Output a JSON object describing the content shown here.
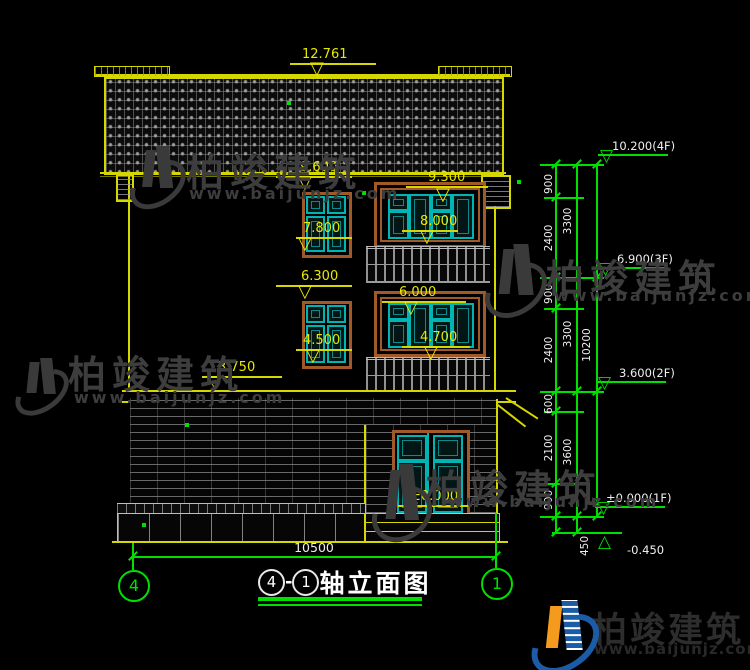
{
  "watermark": {
    "brand": "柏竣建筑",
    "site": "www.baijunjz.com"
  },
  "logo": {
    "brand": "柏竣建筑",
    "site": "www.baijunjz.com"
  },
  "facade": {
    "ridge_elevation": "12.761",
    "f3_left_window_head": "9.600",
    "f3_left_window_sill": "7.800",
    "f3_mid_window_head": "9.300",
    "f3_balcony_rail": "8.000",
    "f2_left_window_head": "6.300",
    "f2_left_window_sill": "4.500",
    "f2_mid_window_head": "6.000",
    "f2_balcony_rail": "4.700",
    "f2_slab": "3.750",
    "canopy": "2.400",
    "ground": "±0.000"
  },
  "bottom": {
    "total_width": "10500",
    "axis_left": "4",
    "axis_right": "1"
  },
  "title": {
    "axis_left": "4",
    "dash": "-",
    "axis_right": "1",
    "label": "轴立面图"
  },
  "right_chain": {
    "levels": [
      "10.200(4F)",
      "6.900(3F)",
      "3.600(2F)",
      "±0.000(1F)",
      "-0.450"
    ],
    "segments": [
      "900",
      "2400",
      "900",
      "2400",
      "600",
      "2100",
      "900"
    ],
    "floors": [
      "3300",
      "3300",
      "3600"
    ],
    "total": "10200",
    "foundation": "450"
  }
}
